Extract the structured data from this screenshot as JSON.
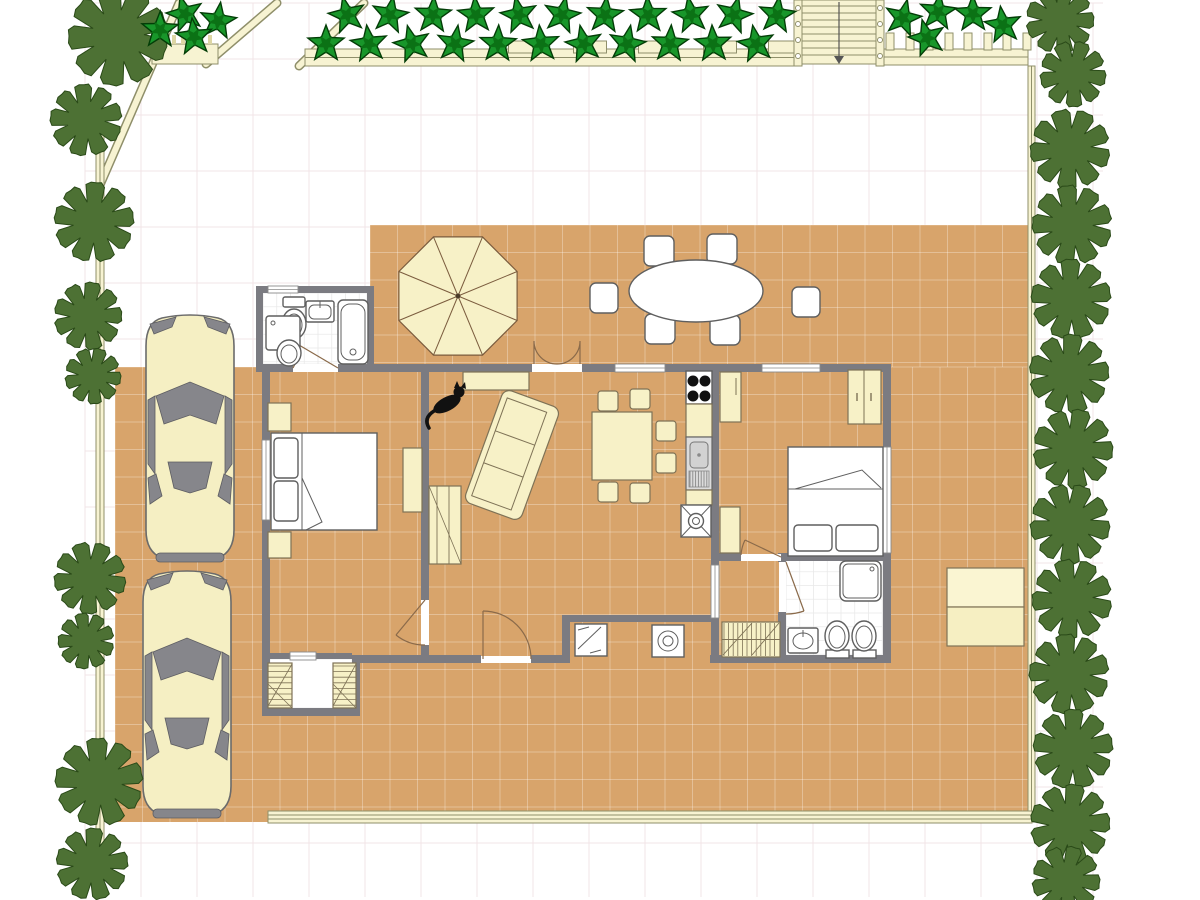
{
  "app": {
    "name": "floor-plan-view",
    "canvas_width": 1200,
    "canvas_height": 900
  },
  "palette": {
    "background": "#ffffff",
    "background_grid_line": "#f2e4e7",
    "terrace_floor": "#d8a46b",
    "terrace_tile_line": "rgba(255,255,255,0.30)",
    "bath_tile_line": "#e9e9e9",
    "wall": "#7b7b81",
    "window_frame": "#8a8a8a",
    "door_arc": "#8a6a4a",
    "furniture_cream": "#f7f1c7",
    "furniture_cream_stroke": "#7e7256",
    "fixture_white": "#ffffff",
    "fixture_stroke": "#5f5f5f",
    "car_body": "#f5efc3",
    "car_glass": "#86868b",
    "tree_fill": "#4d7134",
    "tree_stroke": "#2a4a18",
    "star_light": "#18962a",
    "star_dark": "#0b7215",
    "star_stroke": "#033d07",
    "fence_fill": "#f7f3d2",
    "fence_stroke": "#8f8f6a"
  },
  "grid": {
    "background_spacing": 56,
    "terrace_tile_spacing": 27.5,
    "bath_tile_spacing": 13.75
  },
  "inventory": {
    "rooms": [
      "bedroom-1",
      "living-dining-room",
      "kitchen",
      "bedroom-2",
      "bathroom-1",
      "bathroom-2",
      "corridor",
      "storage-alcove",
      "laundry-nook",
      "patio-terrace",
      "driveway"
    ],
    "furniture": [
      "double-bed-1",
      "double-bed-2",
      "sofa",
      "bookshelf",
      "dining-table",
      "dining-chairs",
      "wardrobes",
      "nightstands",
      "dresser",
      "cooktop",
      "kitchen-sink",
      "bathtub",
      "shower",
      "toilets",
      "washbasins",
      "washing-machine",
      "dishwasher",
      "doormat",
      "shelf-units"
    ],
    "outdoor": [
      "patio-umbrella",
      "oval-patio-table",
      "patio-chairs",
      "garden-table",
      "car-1",
      "car-2",
      "staircase",
      "fences",
      "star-plants",
      "trees"
    ]
  },
  "plants": {
    "trees": [
      {
        "x": 118,
        "y": 36,
        "r": 50
      },
      {
        "x": 86,
        "y": 120,
        "r": 36
      },
      {
        "x": 94,
        "y": 222,
        "r": 40
      },
      {
        "x": 88,
        "y": 316,
        "r": 34
      },
      {
        "x": 93,
        "y": 376,
        "r": 28
      },
      {
        "x": 90,
        "y": 578,
        "r": 36
      },
      {
        "x": 86,
        "y": 641,
        "r": 28
      },
      {
        "x": 99,
        "y": 782,
        "r": 44
      },
      {
        "x": 92,
        "y": 864,
        "r": 36
      },
      {
        "x": 1060,
        "y": 20,
        "r": 34
      },
      {
        "x": 1073,
        "y": 74,
        "r": 33
      },
      {
        "x": 1070,
        "y": 149,
        "r": 40
      },
      {
        "x": 1072,
        "y": 225,
        "r": 40
      },
      {
        "x": 1071,
        "y": 299,
        "r": 40
      },
      {
        "x": 1069,
        "y": 374,
        "r": 40
      },
      {
        "x": 1073,
        "y": 449,
        "r": 40
      },
      {
        "x": 1070,
        "y": 524,
        "r": 40
      },
      {
        "x": 1072,
        "y": 599,
        "r": 40
      },
      {
        "x": 1069,
        "y": 674,
        "r": 40
      },
      {
        "x": 1073,
        "y": 749,
        "r": 40
      },
      {
        "x": 1070,
        "y": 824,
        "r": 40
      },
      {
        "x": 1066,
        "y": 880,
        "r": 34
      }
    ],
    "stars": [
      {
        "x": 185,
        "y": 14
      },
      {
        "x": 218,
        "y": 21
      },
      {
        "x": 160,
        "y": 30
      },
      {
        "x": 194,
        "y": 37
      },
      {
        "x": 347,
        "y": 15
      },
      {
        "x": 390,
        "y": 15
      },
      {
        "x": 433,
        "y": 15
      },
      {
        "x": 476,
        "y": 15
      },
      {
        "x": 519,
        "y": 15
      },
      {
        "x": 562,
        "y": 15
      },
      {
        "x": 605,
        "y": 15
      },
      {
        "x": 648,
        "y": 15
      },
      {
        "x": 691,
        "y": 15
      },
      {
        "x": 734,
        "y": 15
      },
      {
        "x": 777,
        "y": 15
      },
      {
        "x": 326,
        "y": 44
      },
      {
        "x": 369,
        "y": 44
      },
      {
        "x": 412,
        "y": 44
      },
      {
        "x": 455,
        "y": 44
      },
      {
        "x": 498,
        "y": 44
      },
      {
        "x": 541,
        "y": 44
      },
      {
        "x": 584,
        "y": 44
      },
      {
        "x": 627,
        "y": 44
      },
      {
        "x": 670,
        "y": 44
      },
      {
        "x": 713,
        "y": 44
      },
      {
        "x": 756,
        "y": 44
      },
      {
        "x": 903,
        "y": 18
      },
      {
        "x": 938,
        "y": 12
      },
      {
        "x": 973,
        "y": 14
      },
      {
        "x": 1003,
        "y": 25
      },
      {
        "x": 927,
        "y": 38
      }
    ]
  },
  "fences": {
    "rail_post_centers_x": [
      525,
      590,
      655,
      720,
      785
    ],
    "picket_positions_x": [
      886,
      906,
      925,
      945,
      964,
      984,
      1003,
      1023
    ]
  }
}
